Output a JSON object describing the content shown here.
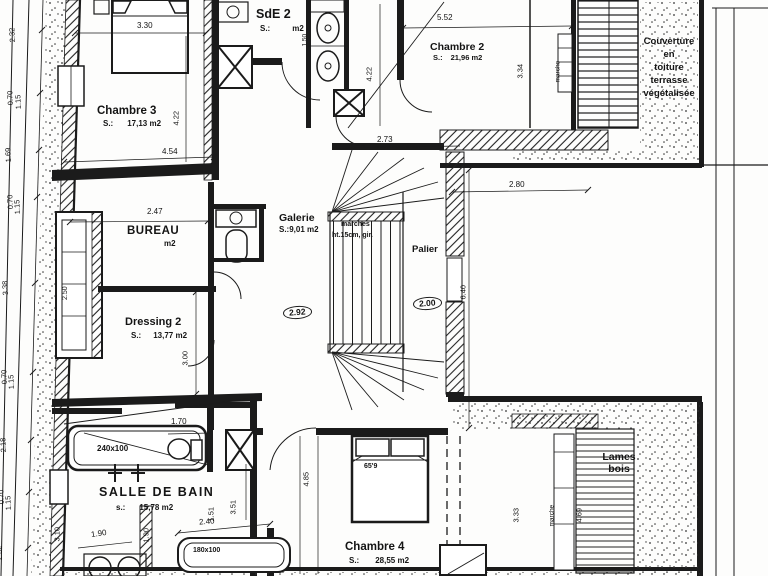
{
  "plan": {
    "rooms": {
      "chambre3": {
        "name": "Chambre 3",
        "s": "S.:",
        "area": "17,13 m2"
      },
      "sde2": {
        "name": "SdE 2",
        "s": "S.:",
        "area": "m2"
      },
      "chambre2": {
        "name": "Chambre 2",
        "s": "S.:",
        "area": "21,96 m2"
      },
      "bureau": {
        "name": "BUREAU",
        "area": "m2"
      },
      "galerie": {
        "name": "Galerie",
        "area": "S.:9,01 m2"
      },
      "palier": {
        "name": "Palier"
      },
      "dressing2": {
        "name": "Dressing 2",
        "s": "S.:",
        "area": "13,77 m2"
      },
      "salle_de_bain": {
        "name": "SALLE DE BAIN",
        "s": "s.:",
        "area": "15,78 m2"
      },
      "chambre4": {
        "name": "Chambre 4",
        "s": "S.:",
        "area": "28,55 m2"
      }
    },
    "annotations": {
      "couverture_l1": "Couverture",
      "couverture_l2": "en",
      "couverture_l3": "toiture",
      "couverture_l4": "terrasse",
      "couverture_l5": "végétalisée",
      "lames_l1": "Lames",
      "lames_l2": "bois",
      "stairs_note1": "marches",
      "stairs_note2": "ht.15cm, gir.",
      "marche_top": "marche",
      "marche_bottom": "marche",
      "bathtub_large": "240x100",
      "bathtub_small": "180x100",
      "bed_label": "65'9"
    },
    "dimensions": {
      "h330": "3.30",
      "h454": "4.54",
      "v422a": "4.22",
      "v150": "1.50",
      "v422b": "4.22",
      "h552": "5.52",
      "v334": "3.34",
      "h273": "2.73",
      "h280": "2.80",
      "h247": "2.47",
      "v640": "6.40",
      "v300": "3.00",
      "v250": "2.50",
      "circ292": "2.92",
      "circ200": "2.00",
      "h170": "1.70",
      "v485": "4.85",
      "v310": "3.10",
      "v190": "1.90",
      "h190": "1.90",
      "v351": "3.51",
      "v151": "1.51",
      "h240": "2.40",
      "v333": "3.33",
      "v469": "4.69",
      "chain": [
        "2.32",
        "0.70",
        "1.15",
        "1.69",
        "0.70",
        "1.15",
        "3.38",
        "0.70",
        "1.15",
        "2.18",
        "0.70",
        "1.15",
        "2.02"
      ]
    }
  }
}
